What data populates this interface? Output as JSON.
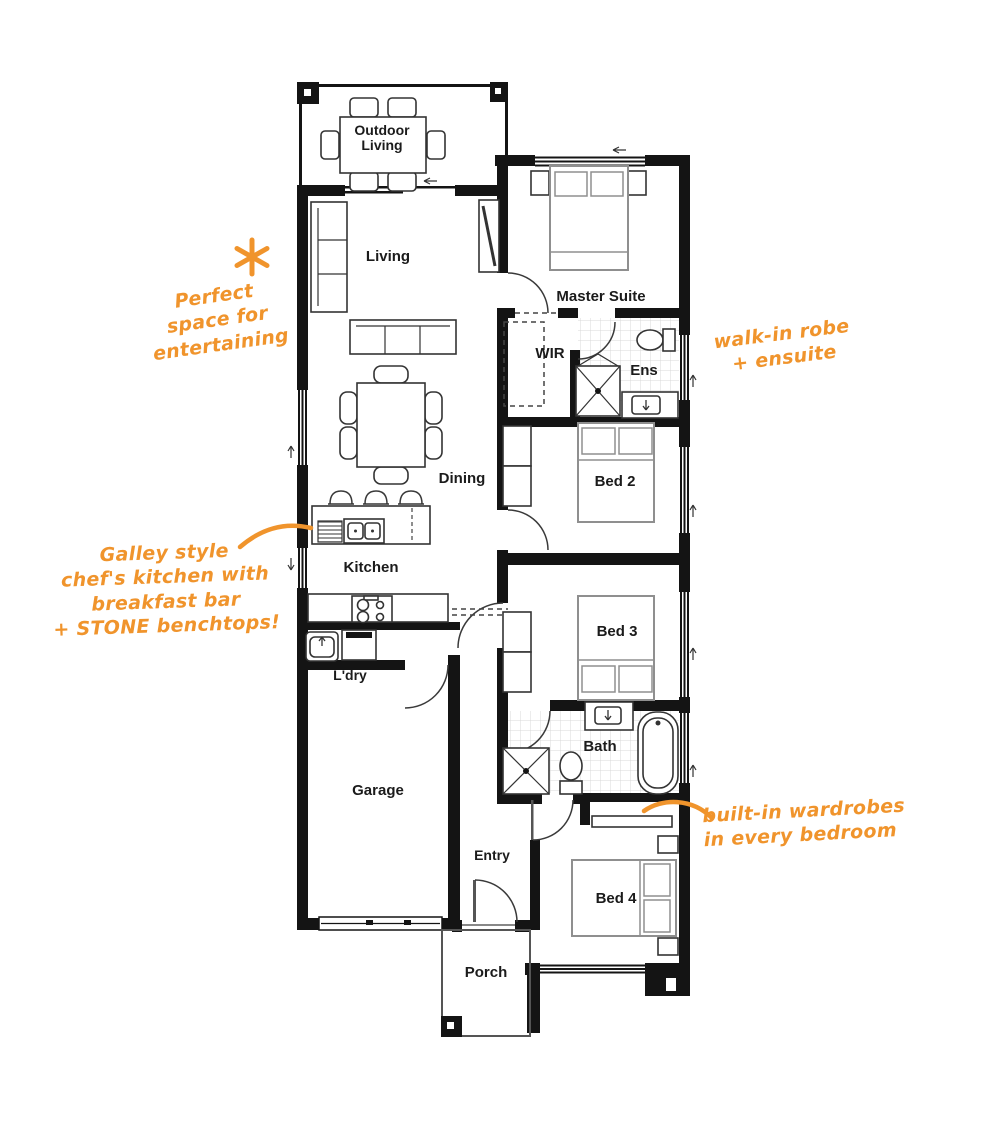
{
  "colors": {
    "annotation_orange": "#F0942C",
    "wall_black": "#141414"
  },
  "rooms": {
    "outdoor_living": {
      "line1": "Outdoor",
      "line2": "Living"
    },
    "living": "Living",
    "master_suite": "Master Suite",
    "wir": "WIR",
    "ens": "Ens",
    "bed2": "Bed 2",
    "dining": "Dining",
    "kitchen": "Kitchen",
    "bed3": "Bed 3",
    "ldry": "L'dry",
    "garage": "Garage",
    "bath": "Bath",
    "entry": "Entry",
    "bed4": "Bed 4",
    "porch": "Porch"
  },
  "annotations": {
    "entertaining": {
      "icon": "asterisk",
      "lines": [
        "Perfect",
        "space for",
        "entertaining"
      ]
    },
    "robe_ensuite": {
      "lines": [
        "walk-in robe",
        "+ ensuite"
      ]
    },
    "kitchen_note": {
      "lines": [
        "Galley style",
        "chef's kitchen with",
        "breakfast bar",
        "+ STONE benchtops!"
      ]
    },
    "wardrobes": {
      "lines": [
        "built-in wardrobes",
        "in every bedroom"
      ]
    }
  }
}
